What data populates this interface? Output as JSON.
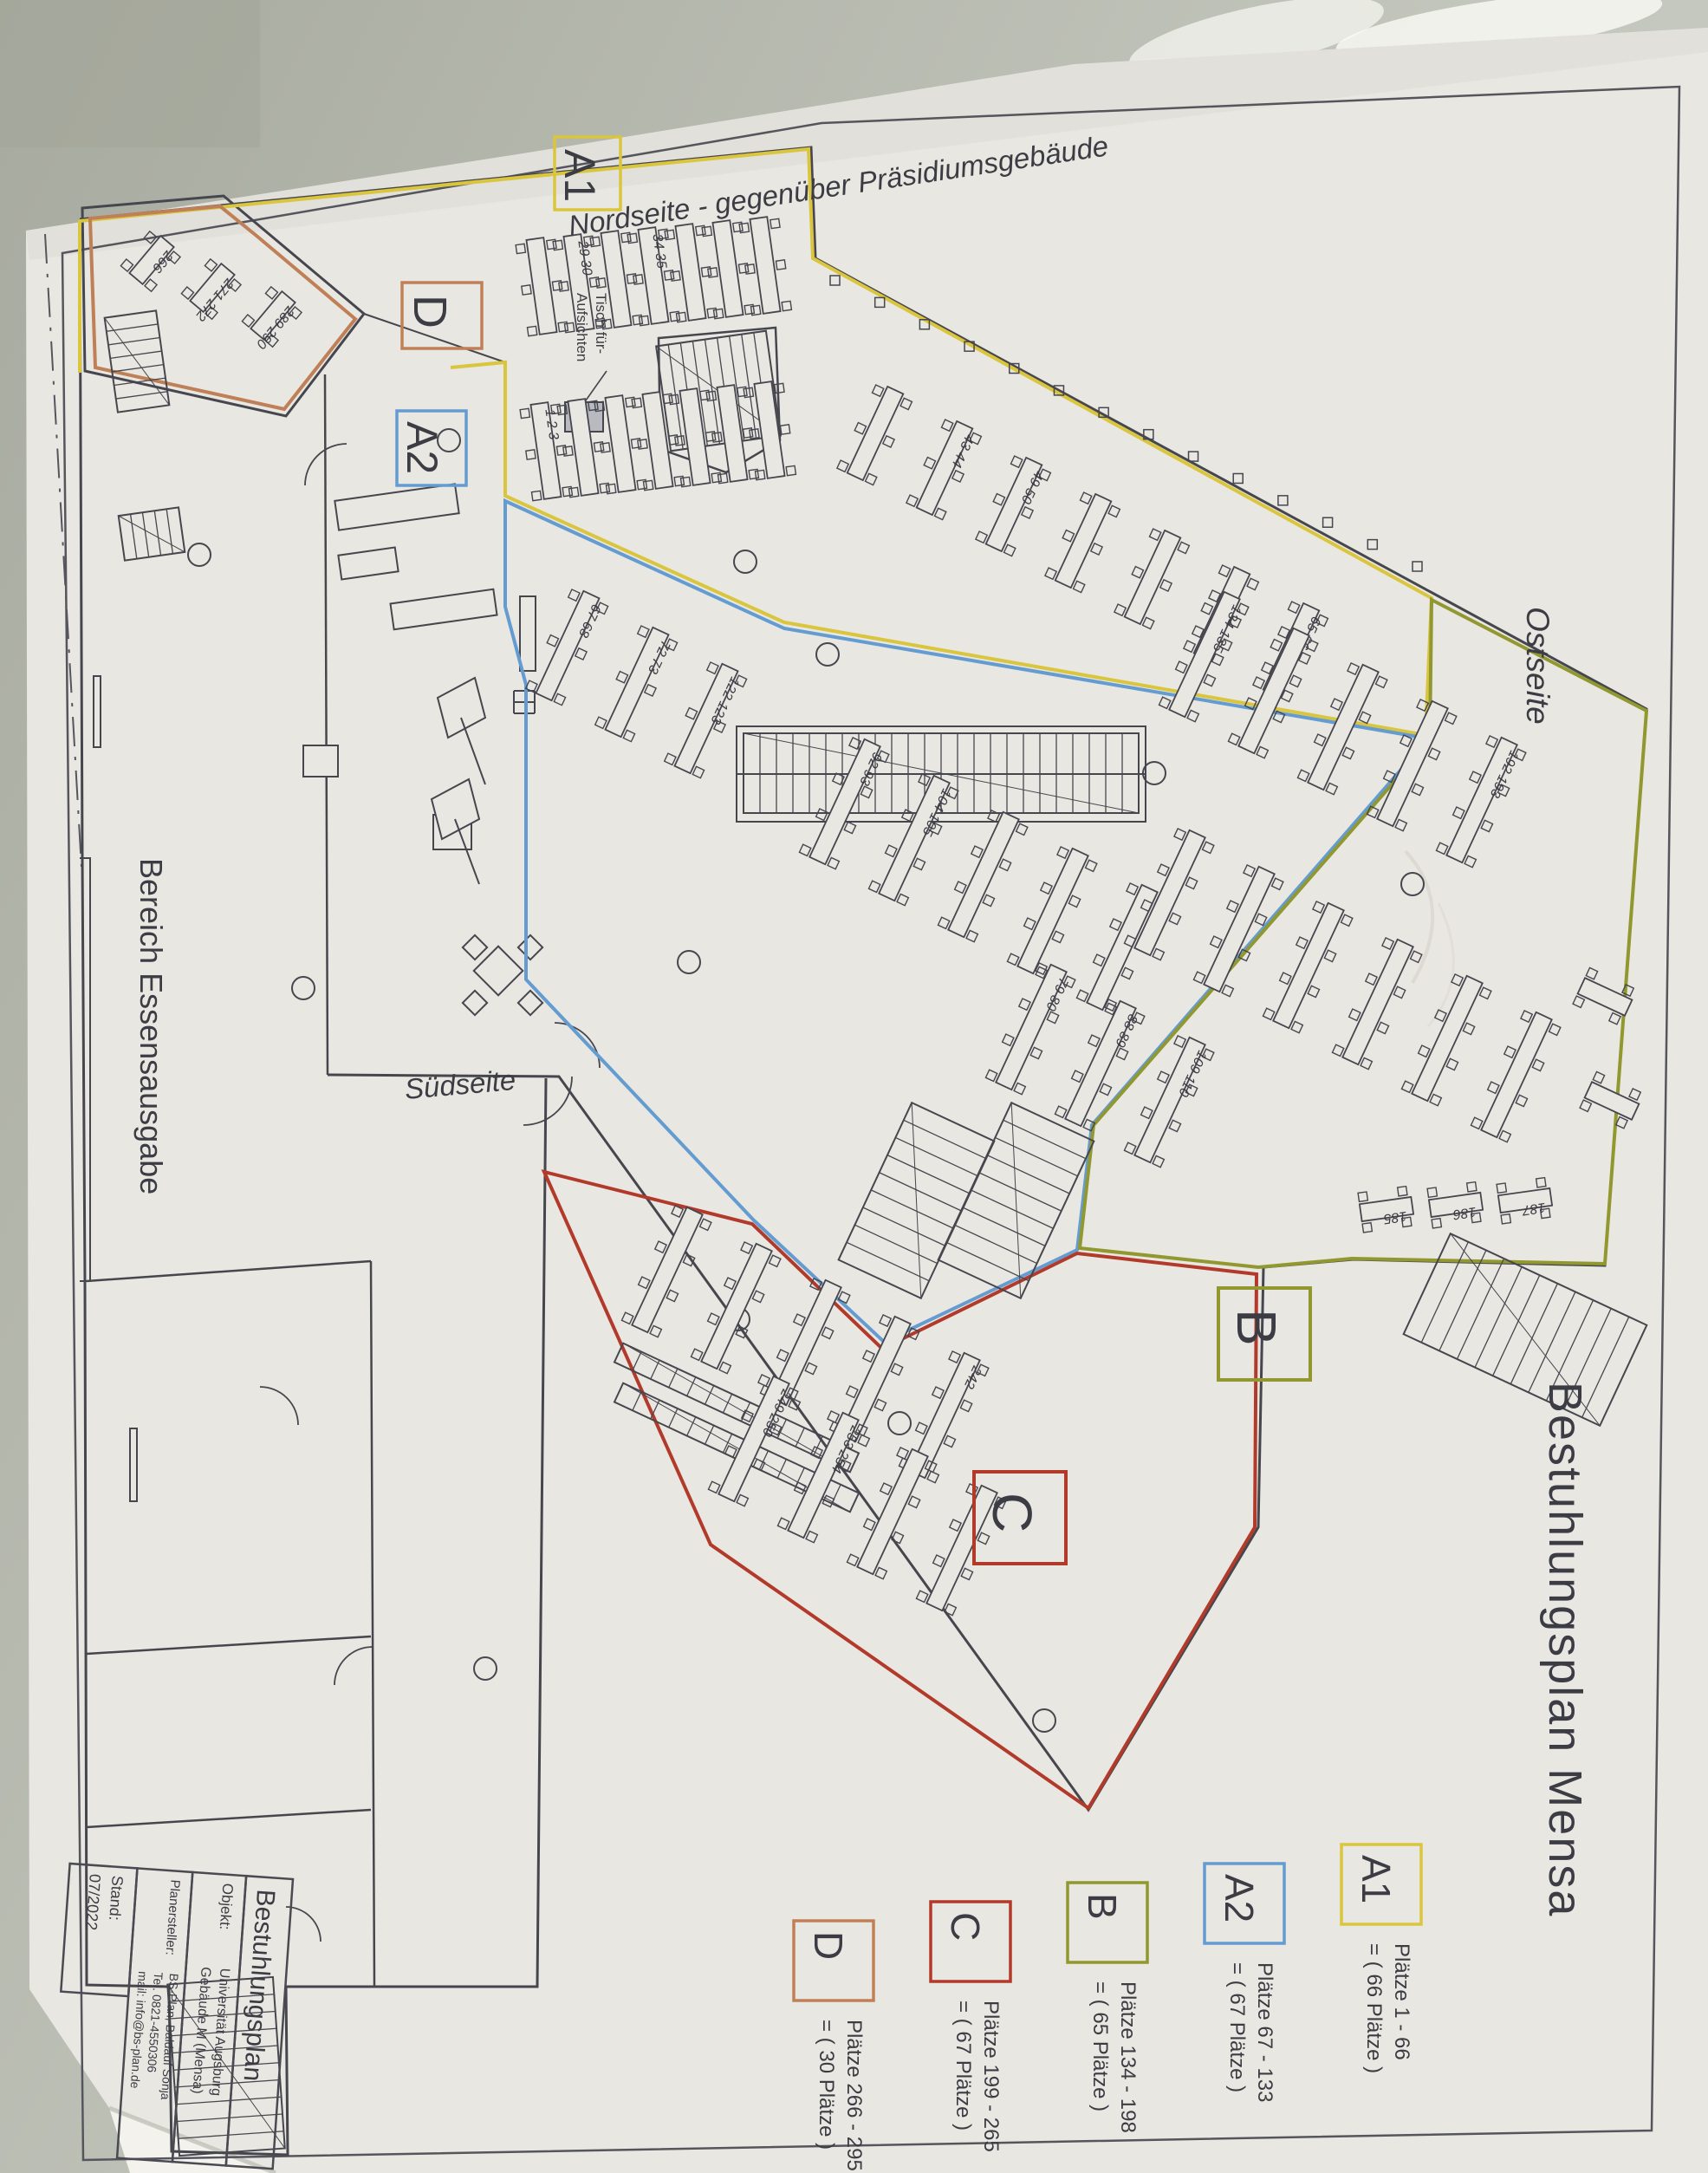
{
  "title_vertical": "Bestuhlungsplan Mensa",
  "labels": {
    "north": "Nordseite - gegenüber Präsidiumsgebäude",
    "east": "Ostseite",
    "south": "Südseite",
    "serving_area": "Bereich Essensausgabe",
    "supervisor_line1": "Tisch für-",
    "supervisor_line2": "Aufsichten"
  },
  "zones": [
    {
      "id": "A1",
      "label": "A1",
      "color": "#d9c53e",
      "range": "Plätze 1 - 66",
      "count": "= ( 66 Plätze )"
    },
    {
      "id": "A2",
      "label": "A2",
      "color": "#649cd1",
      "range": "Plätze 67 - 133",
      "count": "= ( 67 Plätze )"
    },
    {
      "id": "B",
      "label": "B",
      "color": "#91982f",
      "range": "Plätze 134 - 198",
      "count": "= ( 65 Plätze )"
    },
    {
      "id": "C",
      "label": "C",
      "color": "#b23a2b",
      "range": "Plätze 199 - 265",
      "count": "= ( 67 Plätze )"
    },
    {
      "id": "D",
      "label": "D",
      "color": "#bf8058",
      "range": "Plätze 266 - 295",
      "count": "= ( 30 Plätze )"
    }
  ],
  "title_block": {
    "title": "Bestuhlungsplan",
    "objekt_label": "Objekt:",
    "objekt_line1": "Universität Augsburg",
    "objekt_line2": "Gebäude M (Mensa)",
    "planersteller_label": "Planersteller:",
    "planersteller_line1": "BS-Plan, Baldauf Sonja",
    "planersteller_line2": "Tel. 0821-4550306",
    "planersteller_line3": "mail: info@bs-plan.de",
    "stand_label": "Stand:",
    "stand_value": "07/2022"
  },
  "seat_numbers_sample": [
    "1 2 3",
    "29 30",
    "34 35",
    "43 44",
    "49 50",
    "65 66",
    "67 68",
    "72 73",
    "92 93",
    "104 105",
    "79 80",
    "88 89",
    "109 110",
    "122 123",
    "134 135",
    "185",
    "186",
    "187",
    "192 193",
    "242",
    "249 250",
    "253 254",
    "266",
    "271 272",
    "289 290"
  ]
}
